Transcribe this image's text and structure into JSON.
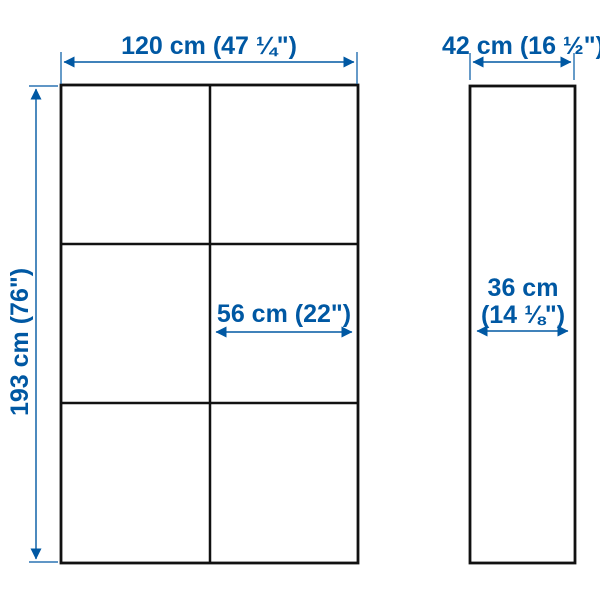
{
  "colors": {
    "dimension": "#0058a3",
    "outline": "#111111",
    "background": "#ffffff"
  },
  "diagram": {
    "kind": "product-dimension-diagram",
    "front_view": {
      "grid": {
        "rows": 3,
        "columns": 2
      },
      "overall_width_label": "120 cm (47 ¼\")",
      "overall_height_label": "193 cm (76\")",
      "door_width_label": "56 cm (22\")"
    },
    "side_view": {
      "overall_depth_label": "42 cm (16 ½\")",
      "inner_depth_label_line1": "36 cm",
      "inner_depth_label_line2": "(14 ⅛\")"
    }
  }
}
